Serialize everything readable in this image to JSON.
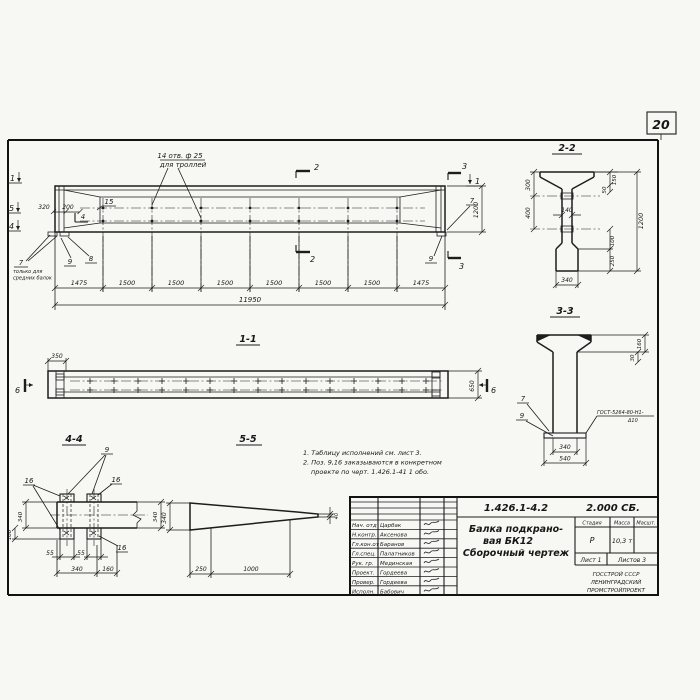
{
  "page": {
    "number": "20"
  },
  "main_view": {
    "hole_note": [
      "14 отв. ф 25",
      "для троллей"
    ],
    "left_markers": [
      "1",
      "5",
      "4"
    ],
    "dim_320": "320",
    "dim_200": "200",
    "pos_15": "15",
    "marker_4_inner": "4",
    "pos_7": "7",
    "pos_7_note": [
      "только для",
      "средних балок"
    ],
    "pos_9": "9",
    "pos_8": "8",
    "marker_2": "2",
    "marker_3": "3",
    "marker_1_right": "1",
    "dim_height": "1200",
    "pos_7_right": "7",
    "pos_9_right": "9",
    "bottom_dims": [
      "1475",
      "1500",
      "1500",
      "1500",
      "1500",
      "1500",
      "1500",
      "1475"
    ],
    "total_dim": "11950"
  },
  "section_2_2": {
    "title": "2-2",
    "dim_300": "300",
    "dim_400": "400",
    "dim_150": "150",
    "dim_50": "50",
    "dim_1200": "1200",
    "dim_100": "100",
    "dim_250": "250",
    "dim_140": "140",
    "dim_340": "340"
  },
  "section_3_3": {
    "title": "3-3",
    "dim_160": "160",
    "dim_30": "30",
    "dim_340": "340",
    "dim_540": "540",
    "pos_7": "7",
    "pos_9": "9",
    "weld_note": [
      "ГОСТ-5264-80-Н1-",
      "Δ10"
    ]
  },
  "section_1_1": {
    "title": "1-1",
    "dim_350": "350",
    "dim_650": "650",
    "marker_6_left": "6",
    "marker_6_right": "6"
  },
  "section_4_4": {
    "title": "4-4",
    "pos_9": "9",
    "pos_16_a": "16",
    "pos_16_b": "16",
    "pos_16_c": "16",
    "dim_340_left": "340",
    "dim_100": "100",
    "dim_340_right": "340",
    "dim_55_a": "55",
    "dim_55_b": "55",
    "dim_340_bottom": "340",
    "dim_160": "160"
  },
  "section_5_5": {
    "title": "5-5",
    "dim_340": "340",
    "dim_40": "40",
    "dim_250": "250",
    "dim_1000": "1000"
  },
  "notes": {
    "line1": "1. Таблицу исполнений см. лист 3.",
    "line2": "2. Поз. 9,16 заказываются в конкретном",
    "line3": "проекте по черт. 1.426.1-41 1 обо."
  },
  "title_block": {
    "doc_number": "1.426.1-4.2",
    "doc_code": "2.000 СБ.",
    "title_lines": [
      "Балка подкрано-",
      "вая БК12",
      "Сборочный чертеж"
    ],
    "col_stage": "Стадия",
    "col_mass": "Масса",
    "col_scale": "Масшт.",
    "stage": "Р",
    "mass": "10,3 т",
    "sheet": "Лист 1",
    "sheets": "Листов 3",
    "org_lines": [
      "ГОССТРОЙ СССР",
      "ЛЕНИНГРАДСКИЙ",
      "ПРОМСТРОЙПРОЕКТ"
    ],
    "signers": [
      {
        "role": "Нач. отд",
        "name": "Царбак"
      },
      {
        "role": "Н.контр.",
        "name": "Аксенова"
      },
      {
        "role": "Гл.кон.от",
        "name": "Баранов"
      },
      {
        "role": "Гл.спец.",
        "name": "Палатников"
      },
      {
        "role": "Рук. гр.",
        "name": "Мединская"
      },
      {
        "role": "Проект.",
        "name": "Гордеева"
      },
      {
        "role": "Провер.",
        "name": "Гордеева"
      },
      {
        "role": "Исполн.",
        "name": "Бабович"
      }
    ]
  }
}
